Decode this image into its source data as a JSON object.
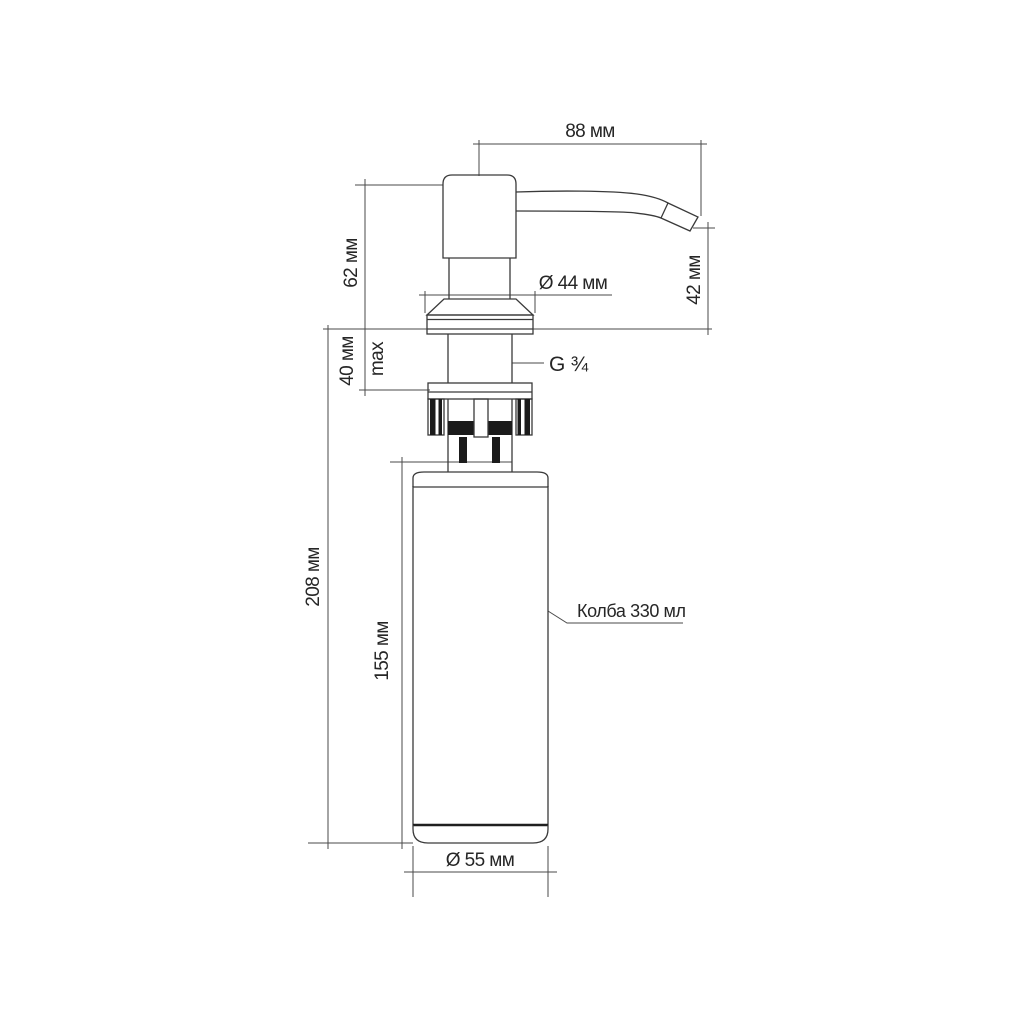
{
  "page": {
    "background": "#ffffff"
  },
  "drawing": {
    "subject": "soap-dispenser-technical-drawing",
    "line_color": "#3a3a3a",
    "fill_color": "#1b1b1b",
    "text_color": "#262626",
    "dimensions": {
      "spout_reach": "88 мм",
      "pump_height": "62 мм",
      "spout_outlet_height": "42 мм",
      "flange_diameter": "Ø 44 мм",
      "mounting_thickness": "40 мм",
      "mounting_thickness_note": "max",
      "thread_size": "G ¾",
      "under_counter_depth": "208 мм",
      "bottle_height": "155 мм",
      "bottle_capacity": "Колба 330 мл",
      "bottle_diameter": "Ø 55 мм"
    }
  }
}
